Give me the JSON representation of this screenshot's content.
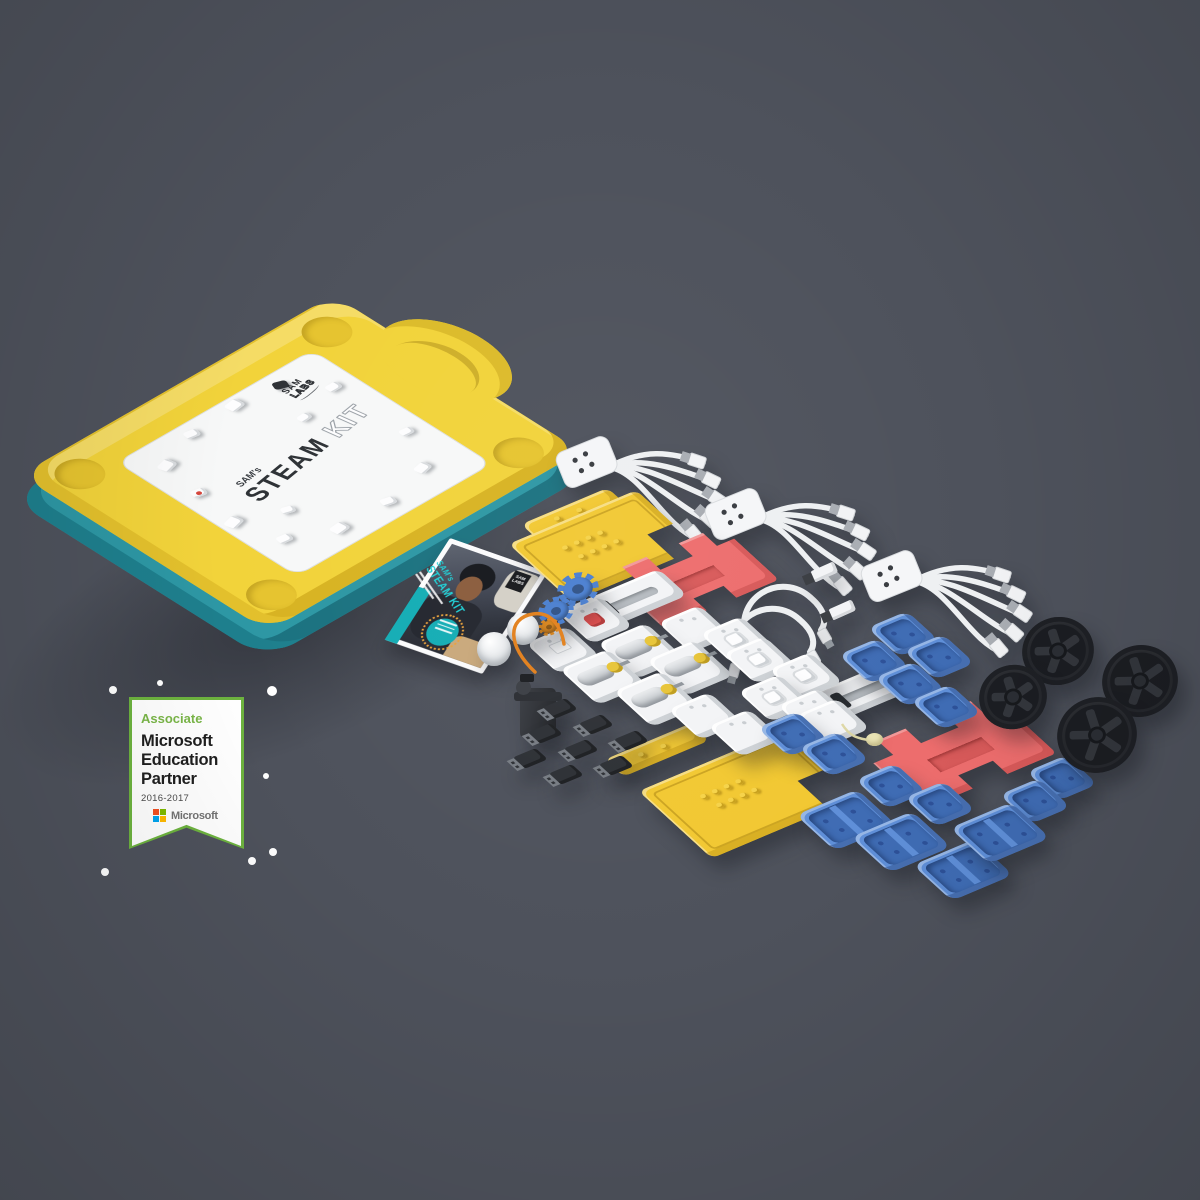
{
  "scene": {
    "background": "#4e525c",
    "description": "SAM Labs STEAM Kit product render: yellow case with teal base, component flat-lay, Microsoft Education Partner badge"
  },
  "badge": {
    "associate": "Associate",
    "line1": "Microsoft",
    "line2": "Education",
    "line3": "Partner",
    "years": "2016-2017",
    "ms_wordmark": "Microsoft",
    "colors": {
      "border": "#6db33f",
      "associate": "#7ab648",
      "ms_red": "#f25022",
      "ms_green": "#7fba00",
      "ms_blue": "#00a4ef",
      "ms_yellow": "#ffb900"
    }
  },
  "case": {
    "lid_small": "SAM's",
    "lid_title": "STEAM",
    "lid_title2": "KIT",
    "logo_line1": "SAM",
    "logo_line2": "LABS",
    "colors": {
      "lid": "#f2d33a",
      "base": "#2d97a4",
      "label": "#f7f8f8"
    },
    "lid_minis": [
      {
        "x": 20,
        "y": 26,
        "s": 15,
        "r": -15
      },
      {
        "x": 66,
        "y": 10,
        "s": 13,
        "r": 10
      },
      {
        "x": 118,
        "y": 5,
        "s": 15,
        "r": -8
      },
      {
        "x": 166,
        "y": 12,
        "s": 13,
        "r": 20,
        "v": "dark"
      },
      {
        "x": 196,
        "y": 44,
        "s": 13,
        "r": 0
      },
      {
        "x": 14,
        "y": 72,
        "s": 13,
        "r": 12,
        "v": "red"
      },
      {
        "x": 6,
        "y": 120,
        "s": 15,
        "r": -14
      },
      {
        "x": 22,
        "y": 166,
        "s": 13,
        "r": 8
      },
      {
        "x": 64,
        "y": 186,
        "s": 15,
        "r": -6
      },
      {
        "x": 120,
        "y": 188,
        "s": 13,
        "r": 14
      },
      {
        "x": 172,
        "y": 174,
        "s": 14,
        "r": -12
      },
      {
        "x": 198,
        "y": 130,
        "s": 12,
        "r": 6
      },
      {
        "x": 150,
        "y": 58,
        "s": 12,
        "r": -4
      },
      {
        "x": 52,
        "y": 140,
        "s": 12,
        "r": 18
      }
    ]
  },
  "booklet": {
    "title_small": "SAM's",
    "title": "STEAM KIT",
    "logo_line1": "SAM",
    "logo_line2": "LABS",
    "accent": "#14adb5"
  },
  "confetti": [
    {
      "x": 113,
      "y": 690,
      "r": 4
    },
    {
      "x": 160,
      "y": 683,
      "r": 3
    },
    {
      "x": 272,
      "y": 691,
      "r": 5
    },
    {
      "x": 266,
      "y": 776,
      "r": 3
    },
    {
      "x": 252,
      "y": 861,
      "r": 4
    },
    {
      "x": 273,
      "y": 852,
      "r": 4
    },
    {
      "x": 105,
      "y": 872,
      "r": 4
    }
  ],
  "palette": {
    "block_white": "#f3f4f6",
    "cover_blue": "#5f8fd8",
    "plate_yellow": "#f2c832",
    "bracket_red": "#ed6d6d",
    "gear_blue": "#4a7fd0",
    "gear_orange": "#e08a1e",
    "wheel_black": "#26282d",
    "cable_white": "#eef0f2",
    "wire_orange": "#e2801c"
  },
  "components": [
    {
      "t": "bundle",
      "x": 551,
      "y": 437
    },
    {
      "t": "bundle",
      "x": 700,
      "y": 489
    },
    {
      "t": "bundle",
      "x": 856,
      "y": 551
    },
    {
      "t": "bar",
      "x": 573,
      "y": 514,
      "w": 96,
      "h": 24
    },
    {
      "t": "plate",
      "x": 604,
      "y": 546,
      "w": 142,
      "h": 88
    },
    {
      "t": "bracket",
      "x": 692,
      "y": 577,
      "w": 128,
      "h": 82
    },
    {
      "t": "bar",
      "x": 657,
      "y": 750,
      "w": 96,
      "h": 26
    },
    {
      "t": "plate",
      "x": 748,
      "y": 794,
      "w": 162,
      "h": 102
    },
    {
      "t": "bracket",
      "x": 957,
      "y": 751,
      "w": 148,
      "h": 92
    },
    {
      "t": "loop",
      "x": 733,
      "y": 578
    },
    {
      "t": "loop",
      "x": 722,
      "y": 600
    },
    {
      "t": "adapter",
      "x": 824,
      "y": 572
    },
    {
      "t": "adapter",
      "x": 842,
      "y": 610
    },
    {
      "t": "slider",
      "x": 628,
      "y": 601,
      "w": 100,
      "h": 40
    },
    {
      "t": "slider",
      "x": 860,
      "y": 693,
      "w": 100,
      "h": 40
    },
    {
      "t": "block",
      "x": 596,
      "y": 620,
      "v": "red"
    },
    {
      "t": "block",
      "x": 563,
      "y": 650,
      "v": "conn"
    },
    {
      "t": "block",
      "x": 695,
      "y": 629,
      "v": "plain"
    },
    {
      "t": "motor",
      "x": 641,
      "y": 651
    },
    {
      "t": "motor",
      "x": 690,
      "y": 668
    },
    {
      "t": "motor",
      "x": 603,
      "y": 677
    },
    {
      "t": "motor",
      "x": 657,
      "y": 699
    },
    {
      "t": "block",
      "x": 737,
      "y": 640,
      "v": "btn"
    },
    {
      "t": "block",
      "x": 760,
      "y": 660,
      "v": "btn"
    },
    {
      "t": "block",
      "x": 806,
      "y": 676,
      "v": "btn"
    },
    {
      "t": "block",
      "x": 775,
      "y": 698,
      "v": "btn"
    },
    {
      "t": "block",
      "x": 815,
      "y": 712,
      "v": "plain"
    },
    {
      "t": "block",
      "x": 705,
      "y": 716,
      "v": "plain"
    },
    {
      "t": "block",
      "x": 745,
      "y": 733,
      "v": "plain"
    },
    {
      "t": "block",
      "x": 833,
      "y": 722,
      "v": "plain"
    },
    {
      "t": "disc",
      "x": 840,
      "y": 722
    },
    {
      "t": "gear",
      "x": 578,
      "y": 589,
      "r": 21,
      "c": "#4a7fd0"
    },
    {
      "t": "gear",
      "x": 556,
      "y": 611,
      "r": 18,
      "c": "#4a7fd0"
    },
    {
      "t": "gear",
      "x": 549,
      "y": 627,
      "r": 11,
      "c": "#e08a1e"
    },
    {
      "t": "dome",
      "x": 523,
      "y": 629,
      "r": 16
    },
    {
      "t": "dome",
      "x": 494,
      "y": 649,
      "r": 17
    },
    {
      "t": "servo",
      "x": 538,
      "y": 710
    },
    {
      "t": "wire",
      "x": 495,
      "y": 600
    },
    {
      "t": "dongle",
      "x": 560,
      "y": 708
    },
    {
      "t": "dongle",
      "x": 596,
      "y": 724
    },
    {
      "t": "dongle",
      "x": 631,
      "y": 740
    },
    {
      "t": "dongle",
      "x": 545,
      "y": 733
    },
    {
      "t": "dongle",
      "x": 581,
      "y": 749
    },
    {
      "t": "dongle",
      "x": 616,
      "y": 765
    },
    {
      "t": "dongle",
      "x": 530,
      "y": 758
    },
    {
      "t": "dongle",
      "x": 566,
      "y": 774
    },
    {
      "t": "cover",
      "x": 903,
      "y": 634
    },
    {
      "t": "cover",
      "x": 939,
      "y": 657
    },
    {
      "t": "cover",
      "x": 874,
      "y": 661
    },
    {
      "t": "cover",
      "x": 910,
      "y": 684
    },
    {
      "t": "cover",
      "x": 946,
      "y": 707
    },
    {
      "t": "cover",
      "x": 793,
      "y": 734
    },
    {
      "t": "cover",
      "x": 834,
      "y": 754
    },
    {
      "t": "cover",
      "x": 891,
      "y": 786
    },
    {
      "t": "cover",
      "x": 940,
      "y": 804
    },
    {
      "t": "cover",
      "x": 1062,
      "y": 778
    },
    {
      "t": "cover",
      "x": 1035,
      "y": 801
    },
    {
      "t": "coverL",
      "x": 846,
      "y": 820
    },
    {
      "t": "coverL",
      "x": 901,
      "y": 842
    },
    {
      "t": "coverL",
      "x": 963,
      "y": 870
    },
    {
      "t": "coverL",
      "x": 1000,
      "y": 833
    },
    {
      "t": "wheel",
      "x": 1058,
      "y": 651,
      "r": 36
    },
    {
      "t": "wheel",
      "x": 1140,
      "y": 681,
      "r": 38
    },
    {
      "t": "wheel",
      "x": 1013,
      "y": 697,
      "r": 34
    },
    {
      "t": "wheel",
      "x": 1097,
      "y": 735,
      "r": 40
    }
  ]
}
